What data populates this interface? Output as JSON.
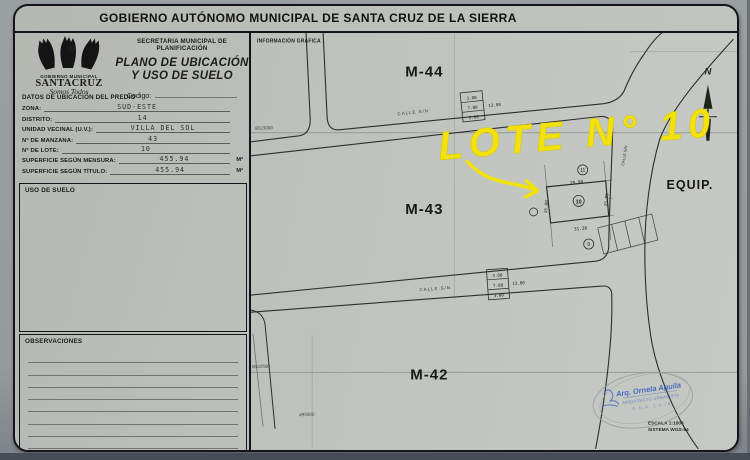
{
  "header": {
    "title": "GOBIERNO AUTÓNOMO MUNICIPAL DE SANTA CRUZ DE LA SIERRA"
  },
  "left_panel": {
    "logo": {
      "line1": "GOBIERNO MUNICIPAL",
      "line2": "SANTACRUZ",
      "line3": "Somos Todos"
    },
    "secretaria": "SECRETARIA MUNICIPAL DE PLANIFICACIÓN",
    "plan_title_line1": "PLANO DE UBICACIÓN",
    "plan_title_line2": "Y USO DE SUELO",
    "codigo_label": "Codigo:",
    "datos_header": "DATOS DE UBICACIÓN DEL PREDIO",
    "fields": [
      {
        "label": "ZONA:",
        "value": "SUD-ESTE",
        "unit": ""
      },
      {
        "label": "DISTRITO:",
        "value": "14",
        "unit": ""
      },
      {
        "label": "UNIDAD VECINAL (U.V.):",
        "value": "VILLA DEL SOL",
        "unit": ""
      },
      {
        "label": "N° DE MANZANA:",
        "value": "43",
        "unit": ""
      },
      {
        "label": "N° DE LOTE:",
        "value": "10",
        "unit": ""
      },
      {
        "label": "SUPERFICIE SEGÚN MENSURA:",
        "value": "455.94",
        "unit": "M²"
      },
      {
        "label": "SUPERFICIE SEGÚN TÍTULO:",
        "value": "455.94",
        "unit": "M²"
      }
    ],
    "uso_header": "USO DE SUELO",
    "observaciones_header": "OBSERVACIONES"
  },
  "map": {
    "info_label": "INFORMACIÓN GRAFICA",
    "blocks": {
      "m44": "M-44",
      "m43": "M-43",
      "m42": "M-42",
      "equip": "EQUIP."
    },
    "highlight": "LOTE N° 10",
    "streets": {
      "calle_top": "CALLE  S/N",
      "calle_bottom": "CALLE  S/N",
      "calle_curve": "CALLE S/N"
    },
    "grid": {
      "north1": "8023000",
      "north2": "8022500",
      "east1": "495500"
    },
    "lot": {
      "number": "10",
      "neighbor_above": "11",
      "neighbor_below": "9",
      "top_dim": "29.98",
      "bottom_dim": "31.20",
      "left_dim": "15.00",
      "right_dim": "15.05"
    },
    "cross_section": {
      "s1": "3.00",
      "s2": "7.00",
      "s3": "3.00",
      "total": "13.00"
    },
    "north_label": "N",
    "scale1": "ESCALA 1:1500",
    "scale2": "SISTEMA WGS-84",
    "stamp": {
      "line1": "Arq. Ornela Aguila",
      "line2": "ARQUITECTO URBANISTA",
      "line3": "R.N.A. 1.4.76"
    }
  },
  "colors": {
    "highlight_yellow": "#f2e10a",
    "stamp_blue": "#3a62c4",
    "ink": "#2f2f2f"
  }
}
